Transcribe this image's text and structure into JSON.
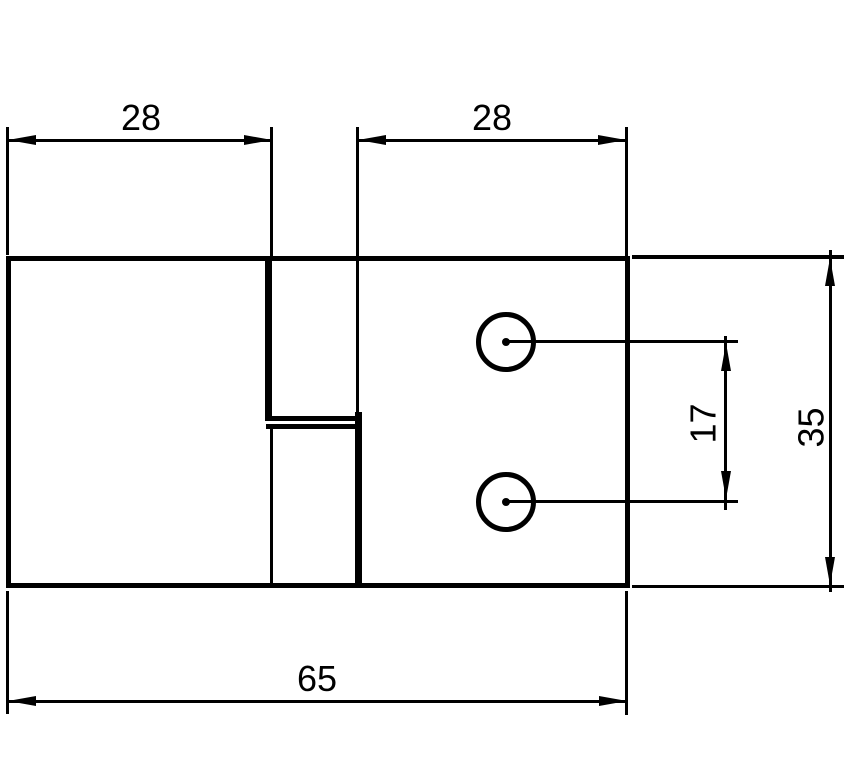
{
  "figure": {
    "kind": "dimensioned technical drawing",
    "part": "rectangular plate with middle step-joint slot and two round holes"
  },
  "colors": {
    "line": "#000000",
    "background": "#ffffff"
  },
  "dims": {
    "top_left_width": "28",
    "top_right_width": "28",
    "hole_spacing": "17",
    "overall_height": "35",
    "overall_width": "65"
  }
}
